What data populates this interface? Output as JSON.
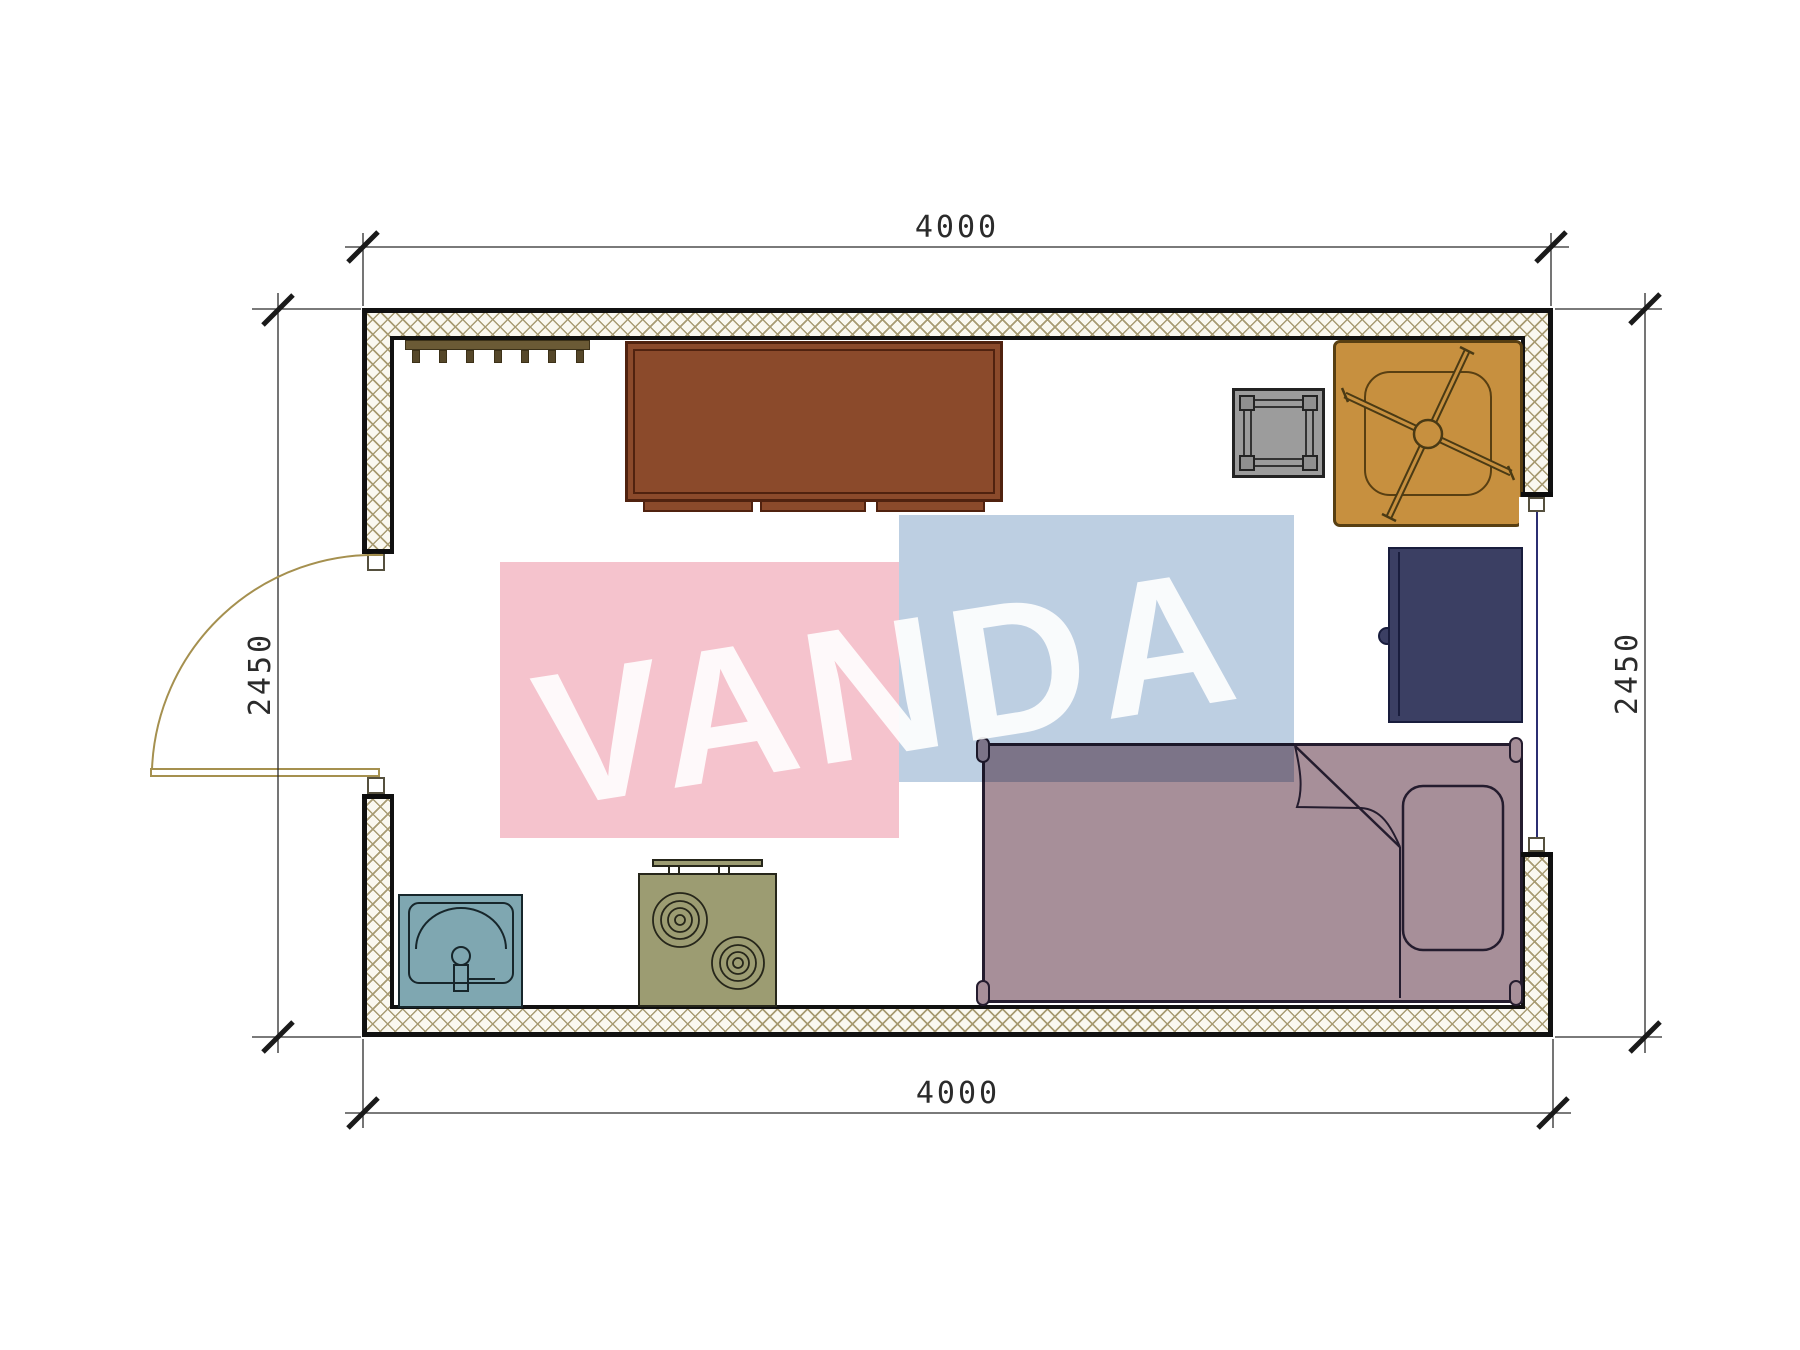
{
  "title": "room-floor-plan",
  "dimensions": {
    "top": "4000",
    "bottom": "4000",
    "left": "2450",
    "right": "2450"
  },
  "watermark": {
    "text": "VANDA"
  },
  "colors": {
    "pink": "#f5c3cd",
    "blue": "#bdcfe2",
    "hatch": "#a89b72",
    "wood": "#8b4a2b",
    "rack": "#6b5a35",
    "stool": "#9c9c9c",
    "chair": "#c7903f",
    "night": "#3b3f63",
    "bed": "#a78f99",
    "sink": "#7fa7b1",
    "stove": "#9c9c72",
    "door": "#a5904f",
    "window": "#2b2e72",
    "dim": "#2b2b2b"
  },
  "furniture": {
    "items": [
      {
        "name": "coat-rack"
      },
      {
        "name": "wardrobe"
      },
      {
        "name": "stool"
      },
      {
        "name": "office-chair"
      },
      {
        "name": "nightstand"
      },
      {
        "name": "bed"
      },
      {
        "name": "sink"
      },
      {
        "name": "stove"
      }
    ]
  }
}
